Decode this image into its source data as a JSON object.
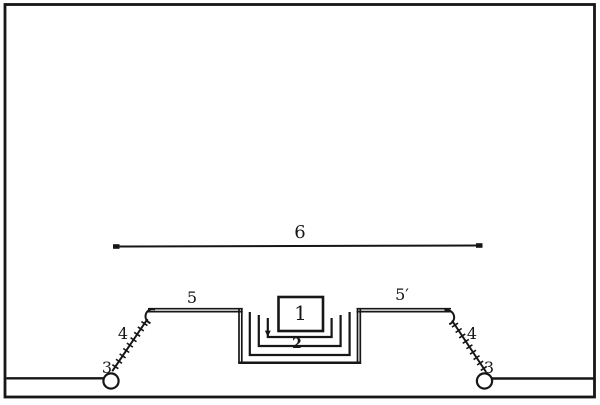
{
  "figure": {
    "ink_color": "#161616",
    "paper_color": "#ffffff",
    "labels": {
      "part1": "1",
      "part2": "2",
      "part3_left": "3",
      "part3_right": "3",
      "part4_left": "4",
      "part4_right": "4",
      "part5_left": "5",
      "part5_right": "5′",
      "part6": "6"
    }
  }
}
